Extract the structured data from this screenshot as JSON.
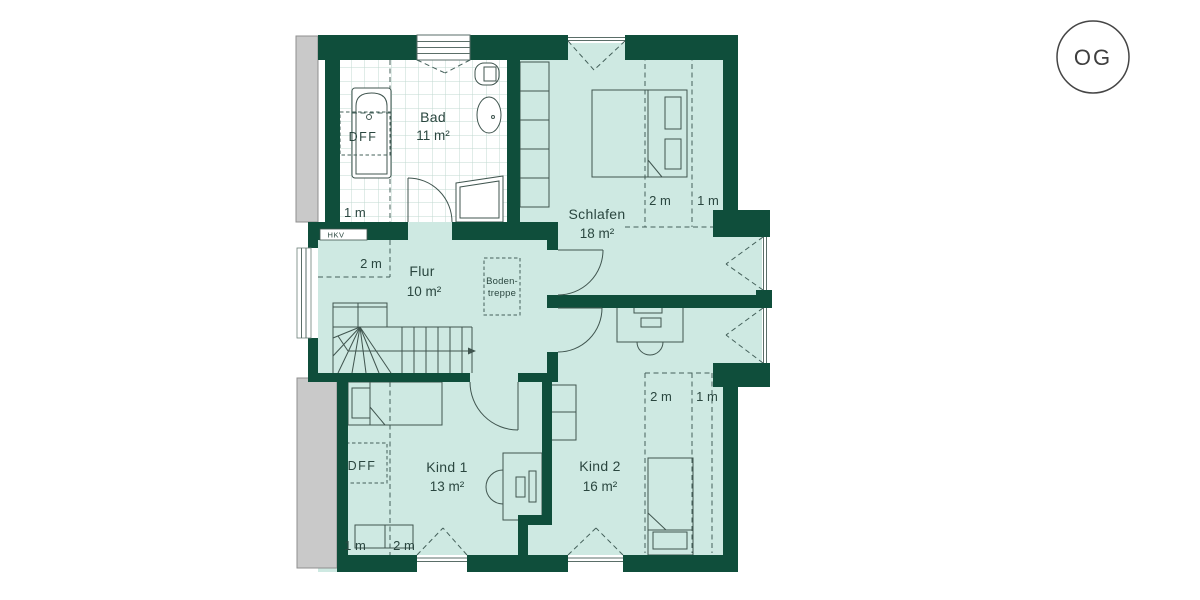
{
  "floor_badge": "OG",
  "rooms": {
    "bad": {
      "name": "Bad",
      "area": "11 m²"
    },
    "schlafen": {
      "name": "Schlafen",
      "area": "18 m²"
    },
    "flur": {
      "name": "Flur",
      "area": "10 m²"
    },
    "kind1": {
      "name": "Kind 1",
      "area": "13 m²"
    },
    "kind2": {
      "name": "Kind 2",
      "area": "16 m²"
    }
  },
  "annotations": {
    "roof_window_bad": "DFF",
    "roof_window_kind1": "DFF",
    "heating_manifold": "HKV",
    "attic_ladder_line1": "Boden-",
    "attic_ladder_line2": "treppe"
  },
  "height_lines": {
    "bad_1m": "1 m",
    "flur_2m": "2 m",
    "schlafen_2m": "2 m",
    "schlafen_1m": "1 m",
    "kind1_1m": "1 m",
    "kind1_2m": "2 m",
    "kind2_2m": "2 m",
    "kind2_1m": "1 m"
  },
  "colors": {
    "wall": "#0f4e3b",
    "room_fill": "#cee9e2",
    "bath_floor": "#ffffff",
    "roof_strip": "#c9c9c9",
    "line": "#40554f",
    "text": "#2a463f"
  }
}
